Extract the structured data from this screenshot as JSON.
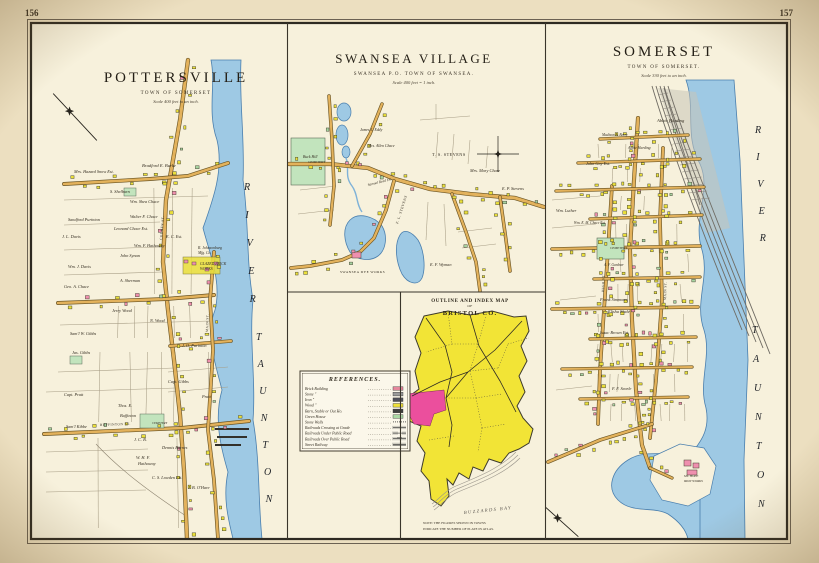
{
  "page": {
    "page_number_left": "156",
    "page_number_right": "157"
  },
  "pottersville": {
    "title": "POTTERSVILLE",
    "subtitle": "TOWN OF SOMERSET",
    "scale_note": "Scale 400 feet to an inch.",
    "river_name": "TAUNTON RIVER",
    "labels": [
      {
        "t": "Mrs. Hazard Snow Est.",
        "x": 74,
        "y": 173
      },
      {
        "t": "Bradford E. Burke",
        "x": 142,
        "y": 167,
        "s": 4.6
      },
      {
        "t": "S. Shelburn",
        "x": 110,
        "y": 193
      },
      {
        "t": "Wm. Shea Chace",
        "x": 130,
        "y": 203
      },
      {
        "t": "Walter F. Chace",
        "x": 130,
        "y": 218
      },
      {
        "t": "Sandford Purinton",
        "x": 68,
        "y": 221
      },
      {
        "t": "J. L. Davis",
        "x": 62,
        "y": 238
      },
      {
        "t": "Leonard Chace Est.",
        "x": 114,
        "y": 230
      },
      {
        "t": "John Synan",
        "x": 120,
        "y": 257
      },
      {
        "t": "Wm. F. Hathaway",
        "x": 134,
        "y": 247
      },
      {
        "t": "E. C. Est.",
        "x": 166,
        "y": 238
      },
      {
        "t": "R. Johnsonburg",
        "x": 198,
        "y": 249,
        "s": 3.8
      },
      {
        "t": "Mfg. Co.",
        "x": 198,
        "y": 254,
        "s": 3.8
      },
      {
        "t": "GLAZED BRICK",
        "x": 200,
        "y": 265,
        "s": 3.8
      },
      {
        "t": "WORKS",
        "x": 200,
        "y": 270,
        "s": 3.8
      },
      {
        "t": "Wm. J. Davis",
        "x": 68,
        "y": 268
      },
      {
        "t": "A. Sherman",
        "x": 120,
        "y": 282
      },
      {
        "t": "Geo. A. Chace",
        "x": 64,
        "y": 288
      },
      {
        "t": "Jerry Wood",
        "x": 112,
        "y": 312
      },
      {
        "t": "N. Wood",
        "x": 150,
        "y": 322
      },
      {
        "t": "J. O. Purinton",
        "x": 182,
        "y": 347
      },
      {
        "t": "Sam'l W. Gibbs",
        "x": 70,
        "y": 335
      },
      {
        "t": "Jas. Gibbs",
        "x": 72,
        "y": 354
      },
      {
        "t": "Capt. Pratt",
        "x": 64,
        "y": 396
      },
      {
        "t": "Capt. Gibbs",
        "x": 168,
        "y": 383
      },
      {
        "t": "Pratt",
        "x": 202,
        "y": 398
      },
      {
        "t": "Thos. E.",
        "x": 118,
        "y": 407
      },
      {
        "t": "Buffinton",
        "x": 120,
        "y": 417
      },
      {
        "t": "Sam'l Kibbe",
        "x": 66,
        "y": 428
      },
      {
        "t": "J. C. B.",
        "x": 134,
        "y": 441
      },
      {
        "t": "Dennis Barnes",
        "x": 162,
        "y": 449
      },
      {
        "t": "W. H. F.",
        "x": 136,
        "y": 459
      },
      {
        "t": "Hathaway",
        "x": 138,
        "y": 465
      },
      {
        "t": "C. S. Lowden Est.",
        "x": 152,
        "y": 479
      },
      {
        "t": "J. B. O'Hare",
        "x": 188,
        "y": 489
      },
      {
        "t": "CEMETERY",
        "x": 152,
        "y": 424,
        "s": 3
      },
      {
        "t": "BUFFINTON  ST.",
        "x": 100,
        "y": 426,
        "s": 3.4,
        "r": -2,
        "u": 1
      },
      {
        "t": "COUNTY  ST.",
        "x": 162,
        "y": 240,
        "s": 3.4,
        "r": -85,
        "u": 1
      },
      {
        "t": "MAIN  ST.",
        "x": 208,
        "y": 332,
        "s": 3.4,
        "r": -88,
        "u": 1
      }
    ]
  },
  "swansea": {
    "title": "SWANSEA VILLAGE",
    "subtitle": "SWANSEA P.O. TOWN OF SWANSEA.",
    "scale_note": "Scale 400 feet = 1 inch.",
    "labels": [
      {
        "t": "Buck Hill",
        "x": 303,
        "y": 158,
        "s": 3.8
      },
      {
        "t": "James L. Eddy",
        "x": 360,
        "y": 131,
        "s": 3.8
      },
      {
        "t": "Mrs. Allen Chace",
        "x": 368,
        "y": 147,
        "s": 3.8
      },
      {
        "t": "T. S. STEVENS",
        "x": 432,
        "y": 156,
        "s": 4.2,
        "u": 1
      },
      {
        "t": "Mrs. Mary Chase",
        "x": 470,
        "y": 172
      },
      {
        "t": "E. P. Stevens",
        "x": 502,
        "y": 190
      },
      {
        "t": "Samuel Reed Est.",
        "x": 368,
        "y": 186,
        "r": -14,
        "s": 3.6
      },
      {
        "t": "F. L. STEVENS",
        "x": 398,
        "y": 224,
        "r": -72,
        "s": 3.6,
        "u": 1
      },
      {
        "t": "E. F. Wyman",
        "x": 430,
        "y": 266
      },
      {
        "t": "SWANSEA DYE WORKS",
        "x": 340,
        "y": 273,
        "s": 3.4,
        "u": 1
      },
      {
        "t": "CEMETERY",
        "x": 308,
        "y": 163,
        "s": 3.4
      }
    ]
  },
  "somerset": {
    "title": "SOMERSET",
    "subtitle": "TOWN OF SOMERSET.",
    "scale_note": "Scale 330 feet to an inch.",
    "river_name": "TAUNTON RIVER",
    "labels": [
      {
        "t": "Abbie Harding",
        "x": 657,
        "y": 122,
        "s": 4.6
      },
      {
        "t": "Madison A. Berry",
        "x": 602,
        "y": 136,
        "s": 3.6
      },
      {
        "t": "Abbie Harding",
        "x": 628,
        "y": 149,
        "s": 3.8
      },
      {
        "t": "John Gay Est.",
        "x": 586,
        "y": 165
      },
      {
        "t": "Wm. Luther",
        "x": 556,
        "y": 212
      },
      {
        "t": "Wm. E. M. Chace Est.",
        "x": 574,
        "y": 224,
        "s": 3.6
      },
      {
        "t": "CEMETERY",
        "x": 610,
        "y": 249,
        "s": 3.4
      },
      {
        "t": "A. F. Gardner",
        "x": 604,
        "y": 266,
        "s": 3.6
      },
      {
        "t": "Frank Simmons",
        "x": 600,
        "y": 301
      },
      {
        "t": "Elisha Slade",
        "x": 608,
        "y": 313
      },
      {
        "t": "Isaac Brown Est.",
        "x": 600,
        "y": 334
      },
      {
        "t": "F. F. Searle",
        "x": 612,
        "y": 390
      },
      {
        "t": "MT. HOPE",
        "x": 684,
        "y": 477,
        "s": 3.2
      },
      {
        "t": "IRON WORKS",
        "x": 684,
        "y": 482,
        "s": 3.2
      },
      {
        "t": "MAIN  ST.",
        "x": 666,
        "y": 300,
        "s": 3.4,
        "r": -88,
        "u": 1
      },
      {
        "t": "HIGH  ST.",
        "x": 604,
        "y": 292,
        "s": 3.4,
        "r": -88,
        "u": 1
      }
    ]
  },
  "references": {
    "title": "REFERENCES.",
    "building_rows": [
      {
        "label": "Brick Building",
        "color": "#e5879d"
      },
      {
        "label": "Stone ″",
        "color": "#9a9a9a"
      },
      {
        "label": "Iron ″",
        "color": "#50505a"
      },
      {
        "label": "Wood ″",
        "color": "#efe13a"
      },
      {
        "label": "Barn, Stable or Out Ho.",
        "color": "#3f3f3f"
      },
      {
        "label": "Green House",
        "color": "#abd8a5"
      }
    ],
    "symbol_rows": [
      {
        "label": "Stone Walls",
        "kind": "stonewall"
      },
      {
        "label": "Railroads Crossing at Grade",
        "kind": "rr"
      },
      {
        "label": "Railroads Under Public Road",
        "kind": "rr-under"
      },
      {
        "label": "Railroads Over Public Road",
        "kind": "rr-over"
      },
      {
        "label": "Street Railway",
        "kind": "street"
      }
    ]
  },
  "index_map": {
    "title_line1": "OUTLINE AND INDEX MAP",
    "title_line2": "OF",
    "title_line3": "BRISTOL CO.",
    "note_line1": "NOTE: THE FIGURES SHOWN IN TOWNS",
    "note_line2": "INDICATE THE NUMBER OF PLATE IN ATLAS.",
    "bay_label": "BUZZARDS BAY"
  },
  "colors": {
    "paper_outer": "#ecdfc0",
    "paper_inner": "#f7f1dc",
    "water": "#9ec9e4",
    "water_edge": "#4a7fae",
    "road_fill": "#e3b25c",
    "road_edge": "#6b5524",
    "building_yellow": "#eadf3a",
    "building_pink": "#ef8fae",
    "building_green": "#a7d3a0",
    "cemetery_green": "#c2e4bd",
    "index_yellow": "#f2e436",
    "index_magenta": "#eb4f9d",
    "railroad_gray": "#6f6b63"
  }
}
